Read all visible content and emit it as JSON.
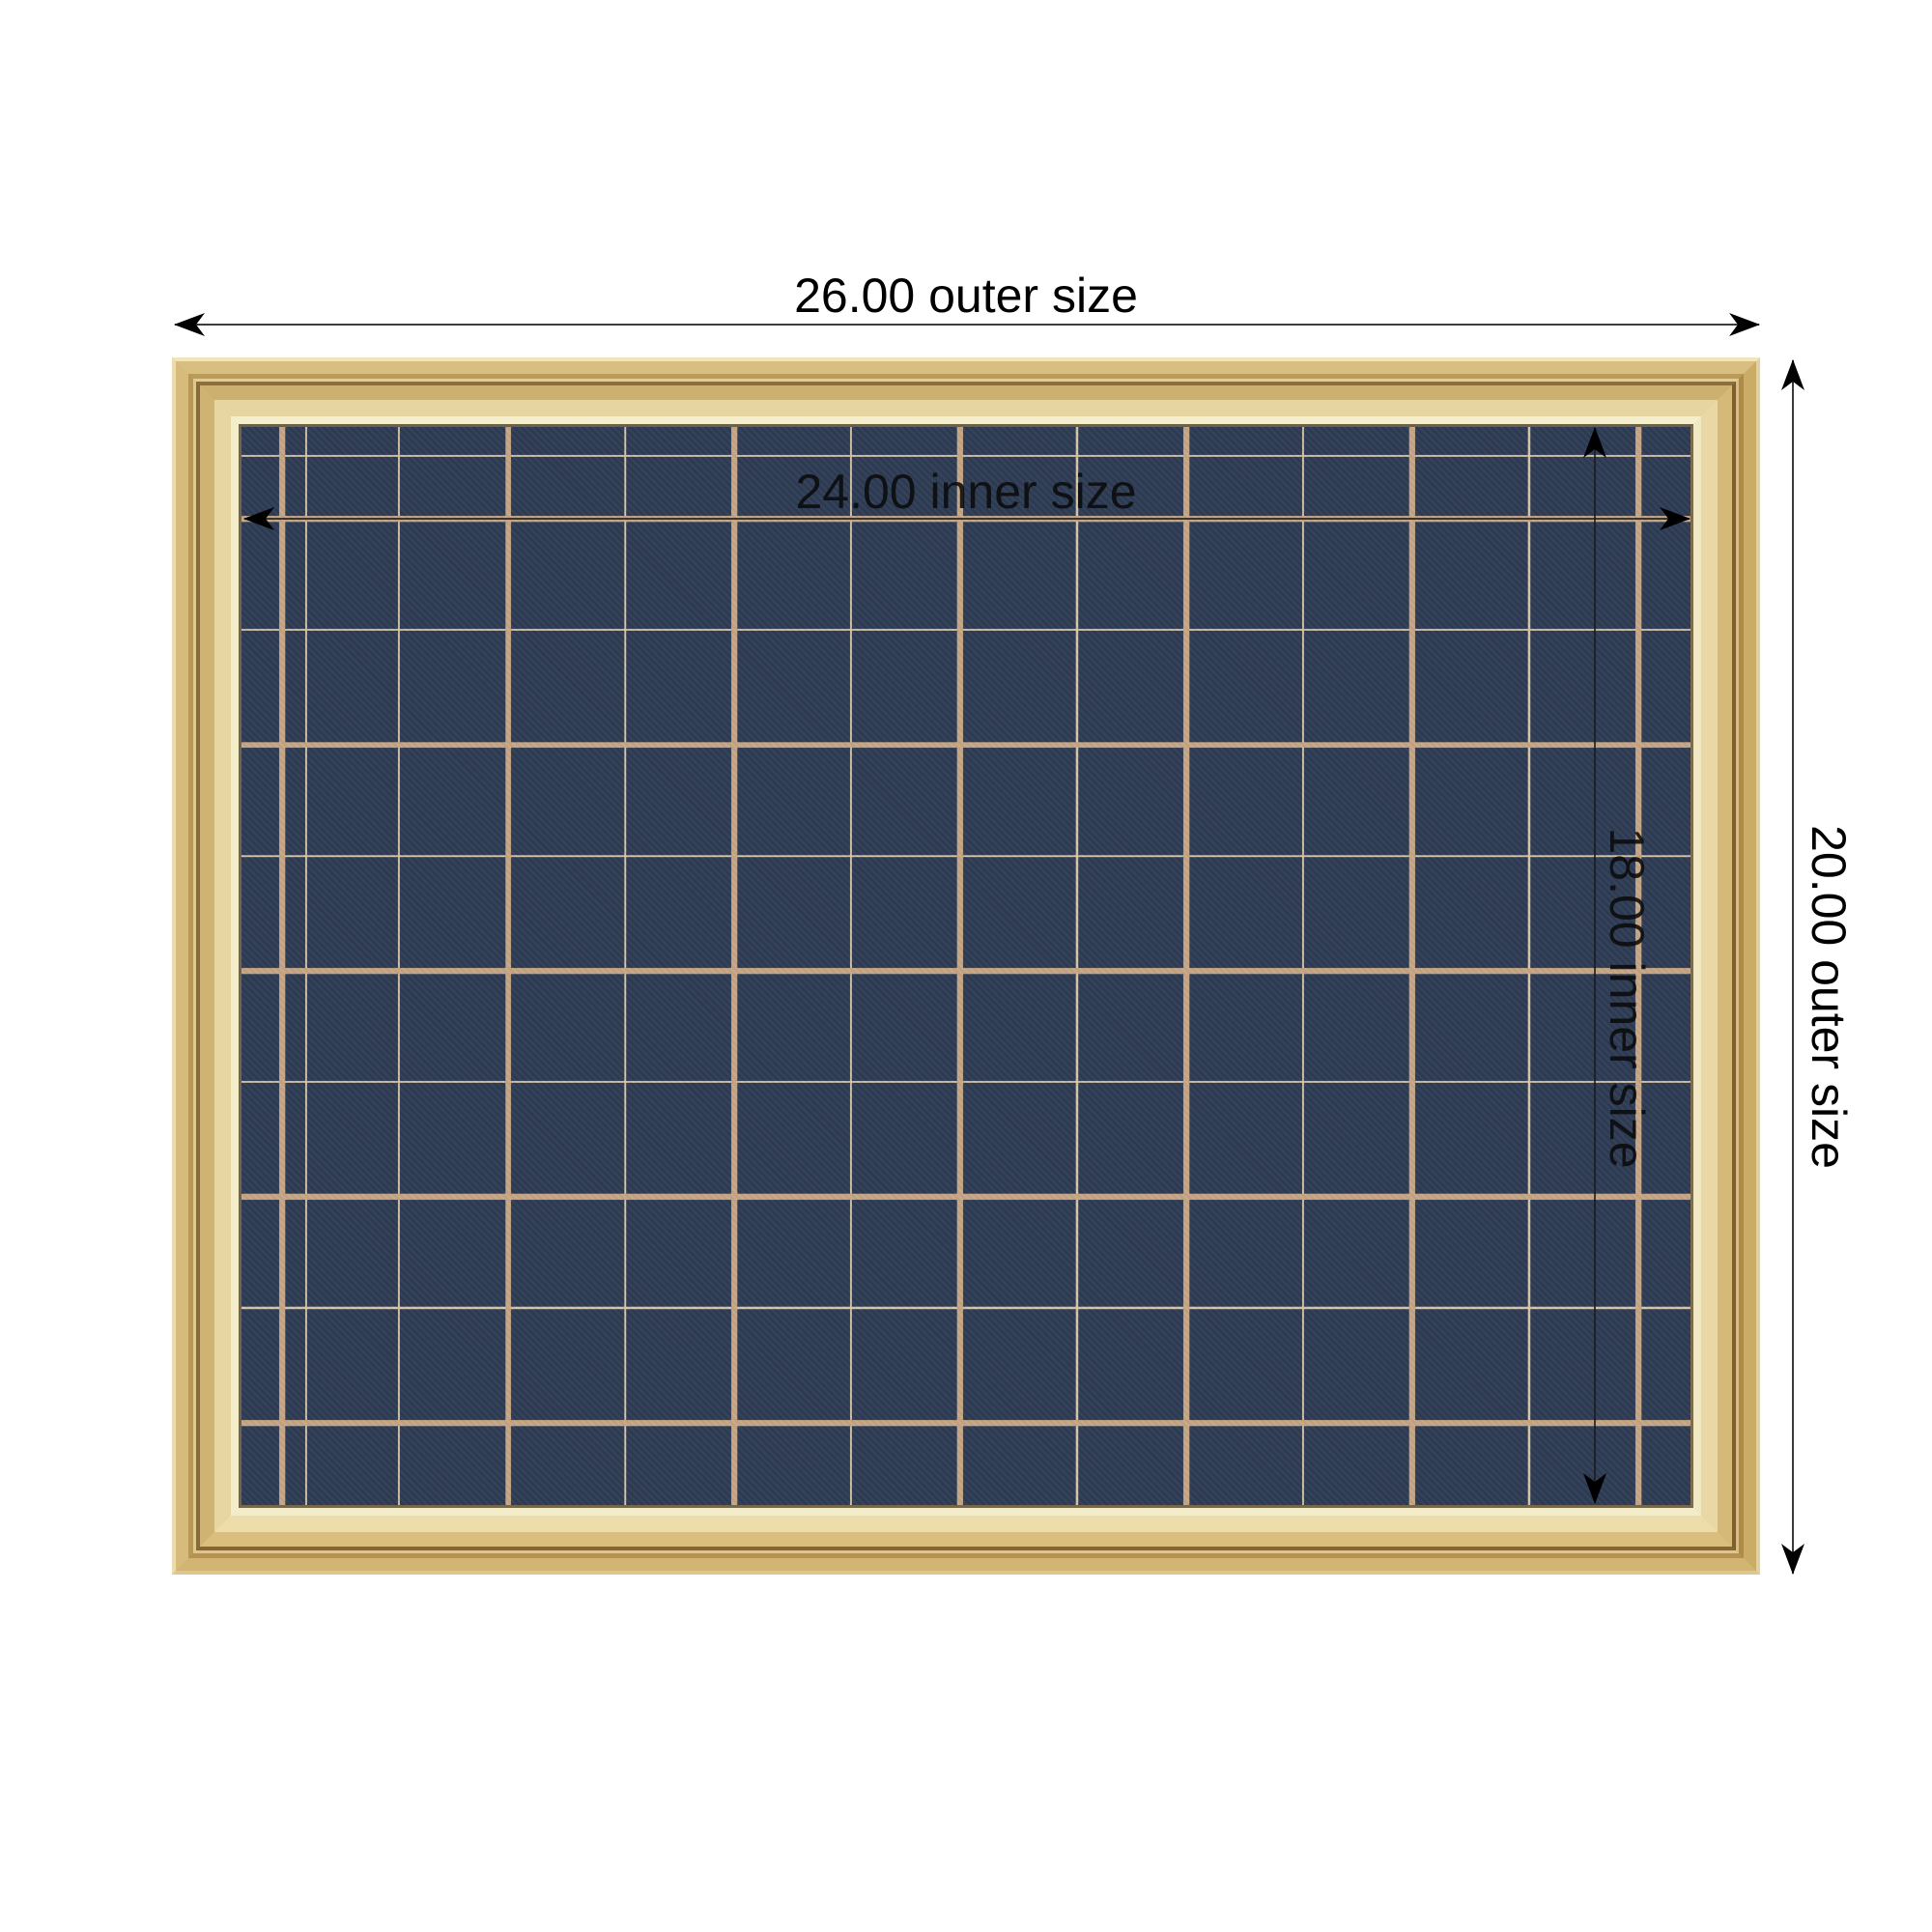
{
  "dimensions": {
    "outer_width": {
      "label": "26.00 outer size"
    },
    "outer_height": {
      "label": "20.00 outer size"
    },
    "inner_width": {
      "label": "24.00 inner size"
    },
    "inner_height": {
      "label": "18.00 inner size"
    }
  },
  "colors": {
    "background": "#ffffff",
    "board_navy": "#2d3b54",
    "grid_thick": "#c6a685",
    "grid_thin": "#d7c5a7",
    "frame_gold": "#e3cf97",
    "frame_gold_deep": "#8e6e3b",
    "frame_lip": "#f4edca",
    "dim_line": "#3c3c3c",
    "dim_text": "#000000"
  }
}
